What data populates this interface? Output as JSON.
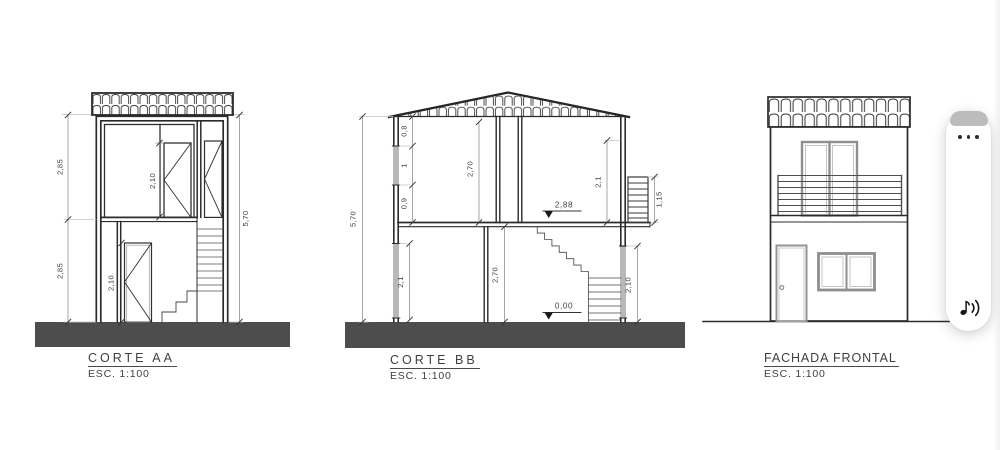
{
  "canvas": {
    "background": "#ffffff"
  },
  "drawings": {
    "corte_aa": {
      "title": "CORTE AA",
      "scale": "ESC. 1:100",
      "dims": {
        "upper_floor_height": "2,85",
        "lower_floor_height": "2,85",
        "upper_door_height": "2,10",
        "lower_door_height": "2,10",
        "total_height": "5,70"
      }
    },
    "corte_bb": {
      "title": "CORTE BB",
      "scale": "ESC. 1:100",
      "dims": {
        "total_height": "5,70",
        "upper_lintel": "0,8",
        "upper_window": "1",
        "upper_sill": "0,9",
        "upper_ceiling": "2,70",
        "upper_right_opening": "2,1",
        "upper_floor_level": "2,88",
        "balcony_railing_height": "1,15",
        "lower_left_opening": "2,1",
        "lower_ceiling": "2,70",
        "lower_right_opening": "2,10",
        "ground_floor_level": "0,00"
      }
    },
    "fachada_frontal": {
      "title": "FACHADA FRONTAL",
      "scale": "ESC. 1:100"
    }
  },
  "widget": {
    "more_options_icon": "ellipsis",
    "read_aloud_icon": "musical-note-with-sound-waves"
  },
  "colors": {
    "line": "#2b2b2b",
    "ground_fill": "#4d4d4d",
    "section_opening_gray": "#b8b8b8",
    "frame_gray": "#8f8f8f",
    "dim_text": "#3d3d3d"
  }
}
